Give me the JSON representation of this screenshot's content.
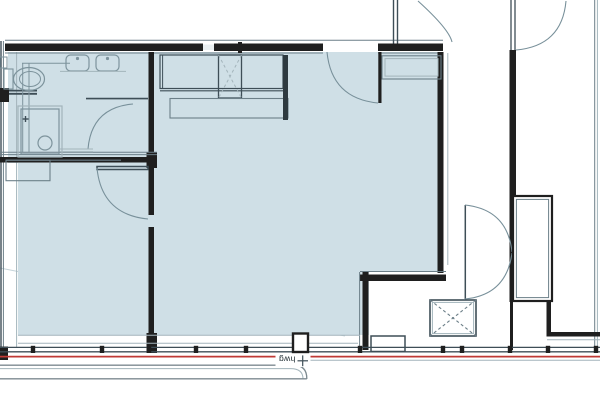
{
  "colors": {
    "paper": "#ffffff",
    "floor": "#cfdfe6",
    "wall": "#1f1f1f",
    "line_dark": "#3e4e57",
    "line_medium": "#6c7f88",
    "line_light": "#a3b4bb",
    "fixture": "#7d939c",
    "door_arc": "#78909a",
    "red": "#bf3a36",
    "crease": "#c6d4da",
    "slab": "#7d8a90",
    "ink": "#1d2a30"
  },
  "annotations": {
    "label": "hwg",
    "marker": "+"
  },
  "plan": {
    "icons": [
      "sink-icon",
      "toilet-icon",
      "shower-icon",
      "shaft-x-icon",
      "door-swing-icon",
      "survey-cross-icon"
    ]
  }
}
